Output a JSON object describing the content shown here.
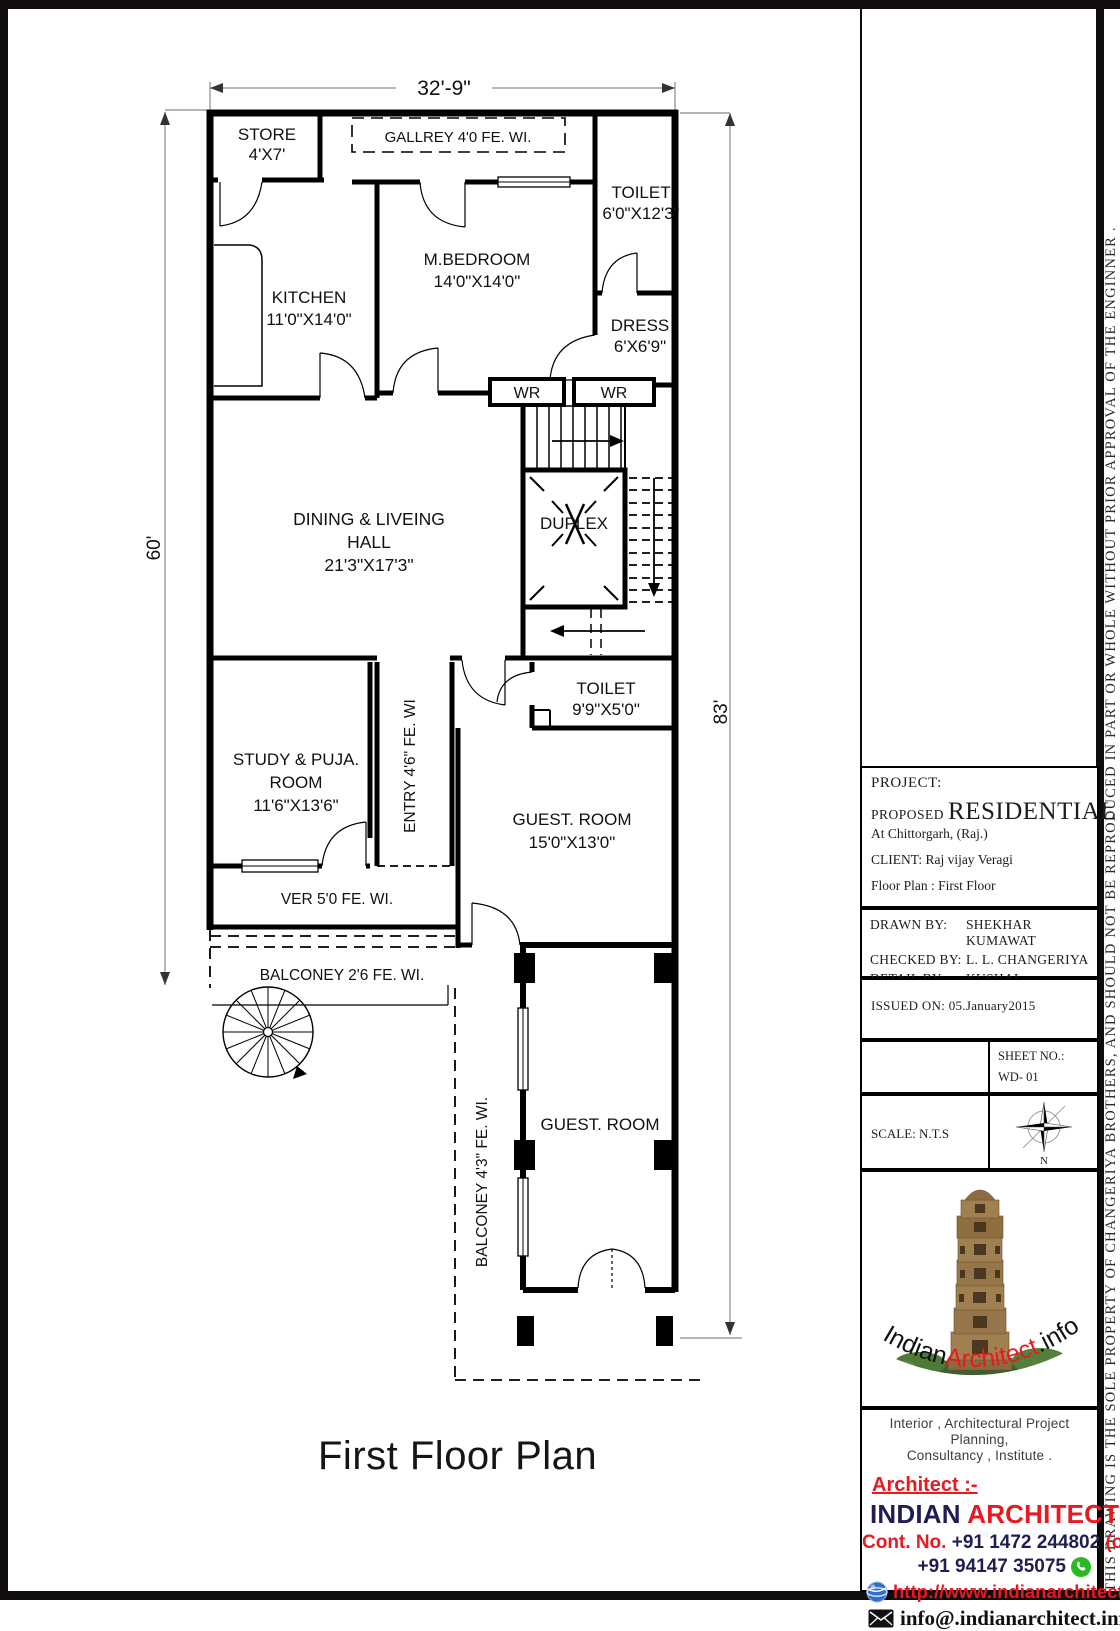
{
  "page": {
    "drawing_title": "First Floor Plan",
    "disclaimer": "THIS DRAWING IS THE SOLE PROPERTY OF CHANGERIYA BROTHERS, AND SHOULD NOT BE REPRODUCED IN PART OR WHOLE WITHOUT PRIOR APPROVAL OF THE ENGINNER ."
  },
  "plan": {
    "dim_top": "32'-9\"",
    "dim_left": "60'",
    "dim_right": "83'",
    "store_name": "STORE",
    "store_size": "4'X7'",
    "gallery": "GALLREY 4'0  FE.   WI.",
    "toilet1_name": "TOILET",
    "toilet1_size": "6'0\"X12'3\"",
    "kitchen_name": "KITCHEN",
    "kitchen_size": "11'0\"X14'0\"",
    "bedroom_name": "M.BEDROOM",
    "bedroom_size": "14'0\"X14'0\"",
    "dress_name": "DRESS",
    "dress_size": "6'X6'9\"",
    "wr1": "WR",
    "wr2": "WR",
    "hall_line1": "DINING & LIVEING",
    "hall_line2": "HALL",
    "hall_size": "21'3\"X17'3\"",
    "duplex": "DUPLEX",
    "toilet2_name": "TOILET",
    "toilet2_size": "9'9\"X5'0\"",
    "study_line1": "STUDY & PUJA.",
    "study_line2": "ROOM",
    "study_size": "11'6\"X13'6\"",
    "entry": "ENTRY 4'6\"  FE.  WI",
    "guest1_name": "GUEST. ROOM",
    "guest1_size": "15'0\"X13'0\"",
    "ver": "VER  5'0   FE.    WI.",
    "balcony1": "BALCONEY  2'6  FE.    WI.",
    "balcony2": "BALCONEY    4'3\"    FE.   WI.",
    "guest2_name": "GUEST. ROOM"
  },
  "title_block": {
    "project_label": "PROJECT:",
    "proposed": "PROPOSED",
    "residential": "RESIDENTIAL",
    "location": "At Chittorgarh, (Raj.)",
    "client": "CLIENT: Raj vijay Veragi",
    "floor_plan": "Floor Plan :   First Floor",
    "drawn_by_label": "DRAWN BY:",
    "drawn_by": "SHEKHAR KUMAWAT",
    "checked_by_label": "CHECKED BY:",
    "checked_by": "L. L. CHANGERIYA",
    "detail_by_label": "DETAIL BY:",
    "detail_by": "KUSHAL CHANGERIYA",
    "issued_on": "ISSUED ON:  05.January2015",
    "sheet_no_label": "SHEET NO.:",
    "sheet_no": "WD- 01",
    "scale": "SCALE: N.T.S",
    "north_label": "N",
    "logo_part1": "Indian",
    "logo_part2": "Architect",
    "logo_part3": ".info",
    "services_line1": "Interior , Architectural Project Planning,",
    "services_line2": "Consultancy , Institute .",
    "architect_label": "Architect :-",
    "firm_part1": "INDIAN",
    "firm_part2": "ARCHITECT",
    "firm_part3": ".INFO",
    "contact_label": "Cont. No.",
    "phone_office": "+91 1472 244802",
    "phone_office_suffix": "(o)",
    "phone_mobile": "+91 94147 35075",
    "website": "http://www.indianarchitect.info/",
    "email": "info@.indianarchitect.info/"
  },
  "colors": {
    "accent_red": "#e8191f",
    "brand_navy": "#1e1e52",
    "whatsapp_green": "#2bb826",
    "globe_blue": "#2f6fd2"
  }
}
